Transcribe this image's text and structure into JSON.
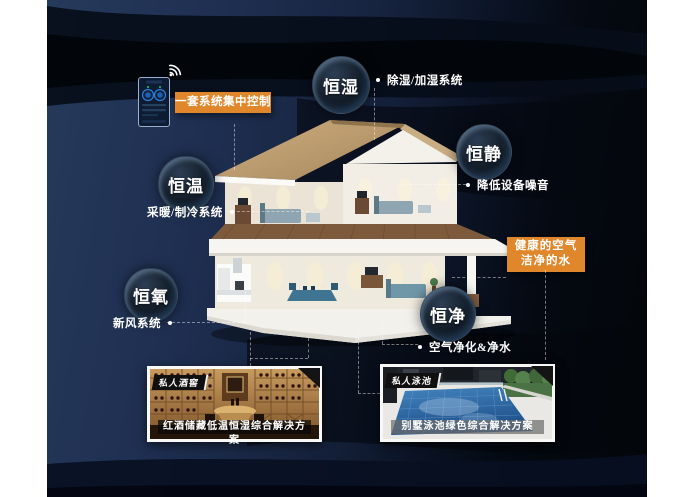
{
  "colors": {
    "accent_orange": "#E0862B",
    "background_navy": "#1B2A49",
    "deep_black": "#04070D",
    "roof_tan": "#C2A074",
    "pool_blue": "#2E6BAC"
  },
  "control": {
    "label": "一套系统集中控制"
  },
  "bubbles": [
    {
      "label": "恒湿",
      "note": "除湿/加湿系统"
    },
    {
      "label": "恒静",
      "note": "降低设备噪音"
    },
    {
      "label": "恒温",
      "note": "采暖/制冷系统"
    },
    {
      "label": "恒氧",
      "note": "新风系统"
    },
    {
      "label": "恒净",
      "note": "空气净化&净水"
    }
  ],
  "highlight": {
    "line1": "健康的空气",
    "line2": "洁净的水"
  },
  "cards": [
    {
      "tag": "私人酒窖",
      "caption": "红酒储藏低温恒湿综合解决方案"
    },
    {
      "tag": "私人泳池",
      "caption": "别墅泳池绿色综合解决方案"
    }
  ]
}
